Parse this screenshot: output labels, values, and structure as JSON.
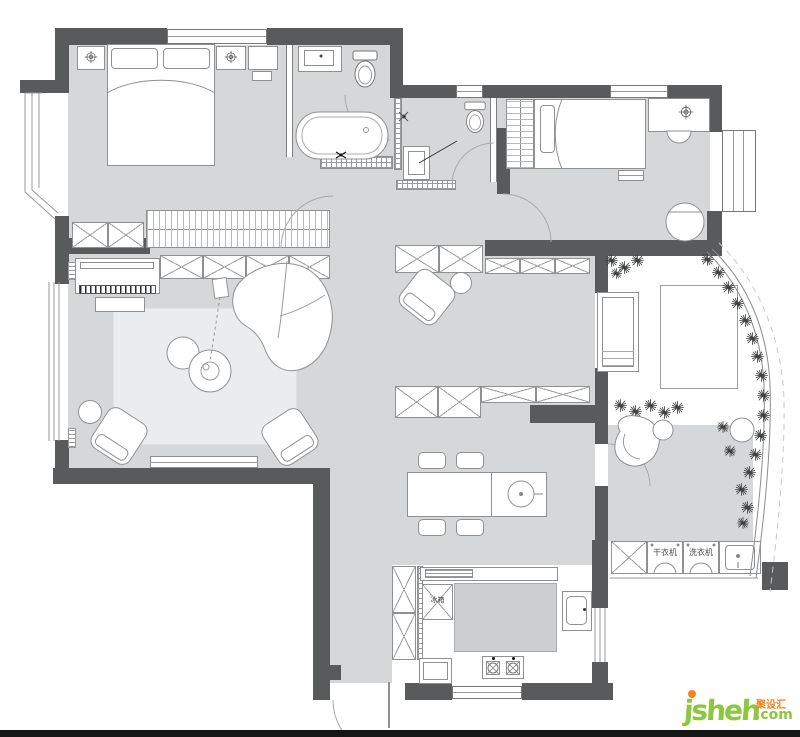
{
  "labels": {
    "fridge": "冰箱",
    "dryer": "干衣机",
    "washer": "洗衣机"
  },
  "watermark": {
    "brand": "jsheh",
    "tld": ".com",
    "cn": "聚设汇"
  },
  "colors": {
    "wall": "#595a5c",
    "floor": "#d6d7d9",
    "rug": "#ebeced",
    "line": "#8f9092",
    "counter": "#cdced0",
    "green": "#8dc63f",
    "orange": "#f58220"
  }
}
